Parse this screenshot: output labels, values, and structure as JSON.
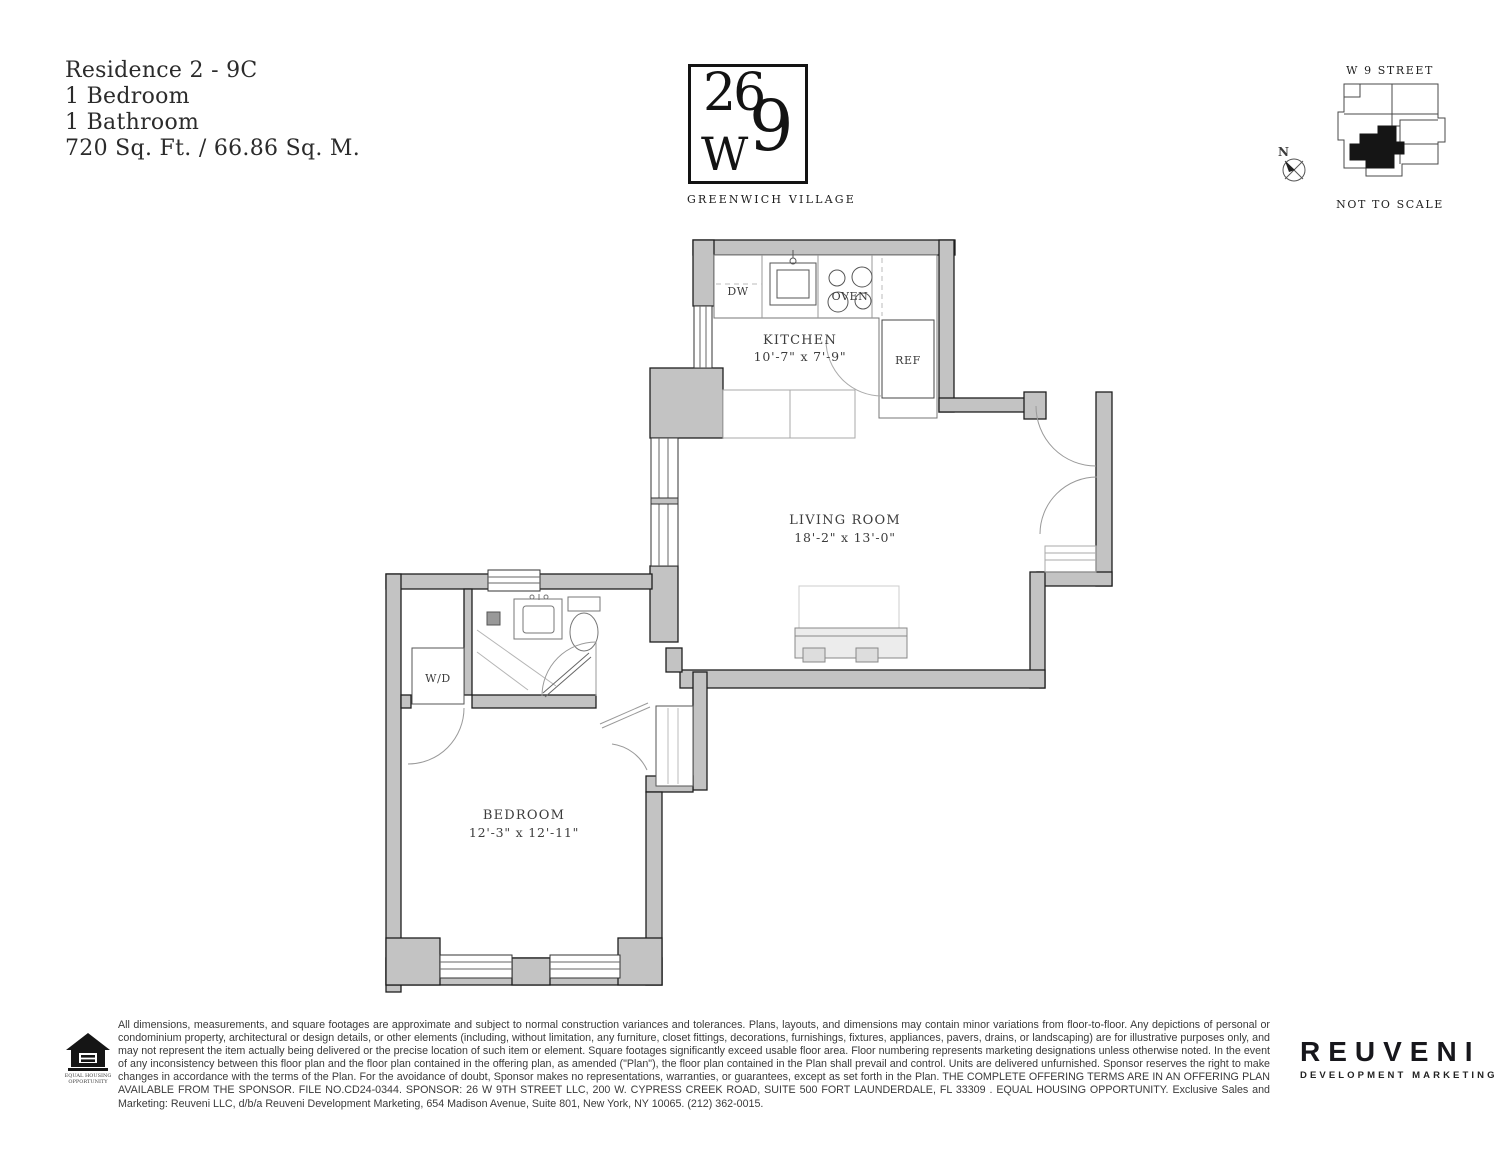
{
  "unit": {
    "residence": "Residence 2 - 9C",
    "bedrooms": "1 Bedroom",
    "bathrooms": "1 Bathroom",
    "area": "720 Sq. Ft. / 66.86 Sq. M."
  },
  "logo": {
    "number_top": "26",
    "letter_w": "W",
    "number_nine": "9",
    "neighborhood": "GREENWICH VILLAGE"
  },
  "keyplan": {
    "street": "W 9 STREET",
    "north": "N",
    "note": "NOT TO SCALE"
  },
  "floorplan": {
    "rooms": [
      {
        "name": "KITCHEN",
        "dims": "10'-7\" x 7'-9\""
      },
      {
        "name": "LIVING ROOM",
        "dims": "18'-2\" x 13'-0\""
      },
      {
        "name": "BEDROOM",
        "dims": "12'-3\" x 12'-11\""
      }
    ],
    "labels": {
      "dw": "DW",
      "oven": "OVEN",
      "ref": "REF",
      "wd": "W/D"
    }
  },
  "footer": {
    "disclaimer": "All dimensions, measurements, and square footages are approximate and subject to normal construction variances and tolerances. Plans, layouts, and dimensions may contain minor variations from floor-to-floor. Any depictions of personal or condominium property, architectural or design details, or other elements (including, without limitation, any furniture, closet fittings, decorations, furnishings, fixtures, appliances, pavers, drains, or landscaping) are for illustrative purposes only, and may not represent the item actually being delivered or the precise location of such item or element. Square footages significantly exceed usable floor area. Floor numbering represents marketing designations unless otherwise noted. In the event of any inconsistency between this floor plan and the floor plan contained in the offering plan, as amended (\"Plan\"), the floor plan contained in the Plan shall prevail and control. Units are delivered unfurnished. Sponsor reserves the right to make changes in accordance with the terms of the Plan. For the avoidance of doubt, Sponsor makes no representations, warranties, or guarantees, except as set forth in the Plan. THE COMPLETE OFFERING TERMS ARE IN AN OFFERING PLAN AVAILABLE FROM THE SPONSOR. FILE NO.CD24-0344. SPONSOR: 26 W 9TH STREET LLC, 200 W. CYPRESS CREEK ROAD, SUITE 500 FORT LAUNDERDALE, FL 33309 . EQUAL HOUSING OPPORTUNITY. Exclusive Sales and Marketing: Reuveni LLC, d/b/a Reuveni Development Marketing, 654 Madison Avenue, Suite 801, New York, NY 10065. (212) 362-0015.",
    "eho_line1": "EQUAL HOUSING",
    "eho_line2": "OPPORTUNITY",
    "brand": "REUVENI",
    "brand_sub": "DEVELOPMENT MARKETING"
  },
  "colors": {
    "wall": "#c3c3c3",
    "line": "#1f1f1f",
    "ink": "#131313"
  }
}
